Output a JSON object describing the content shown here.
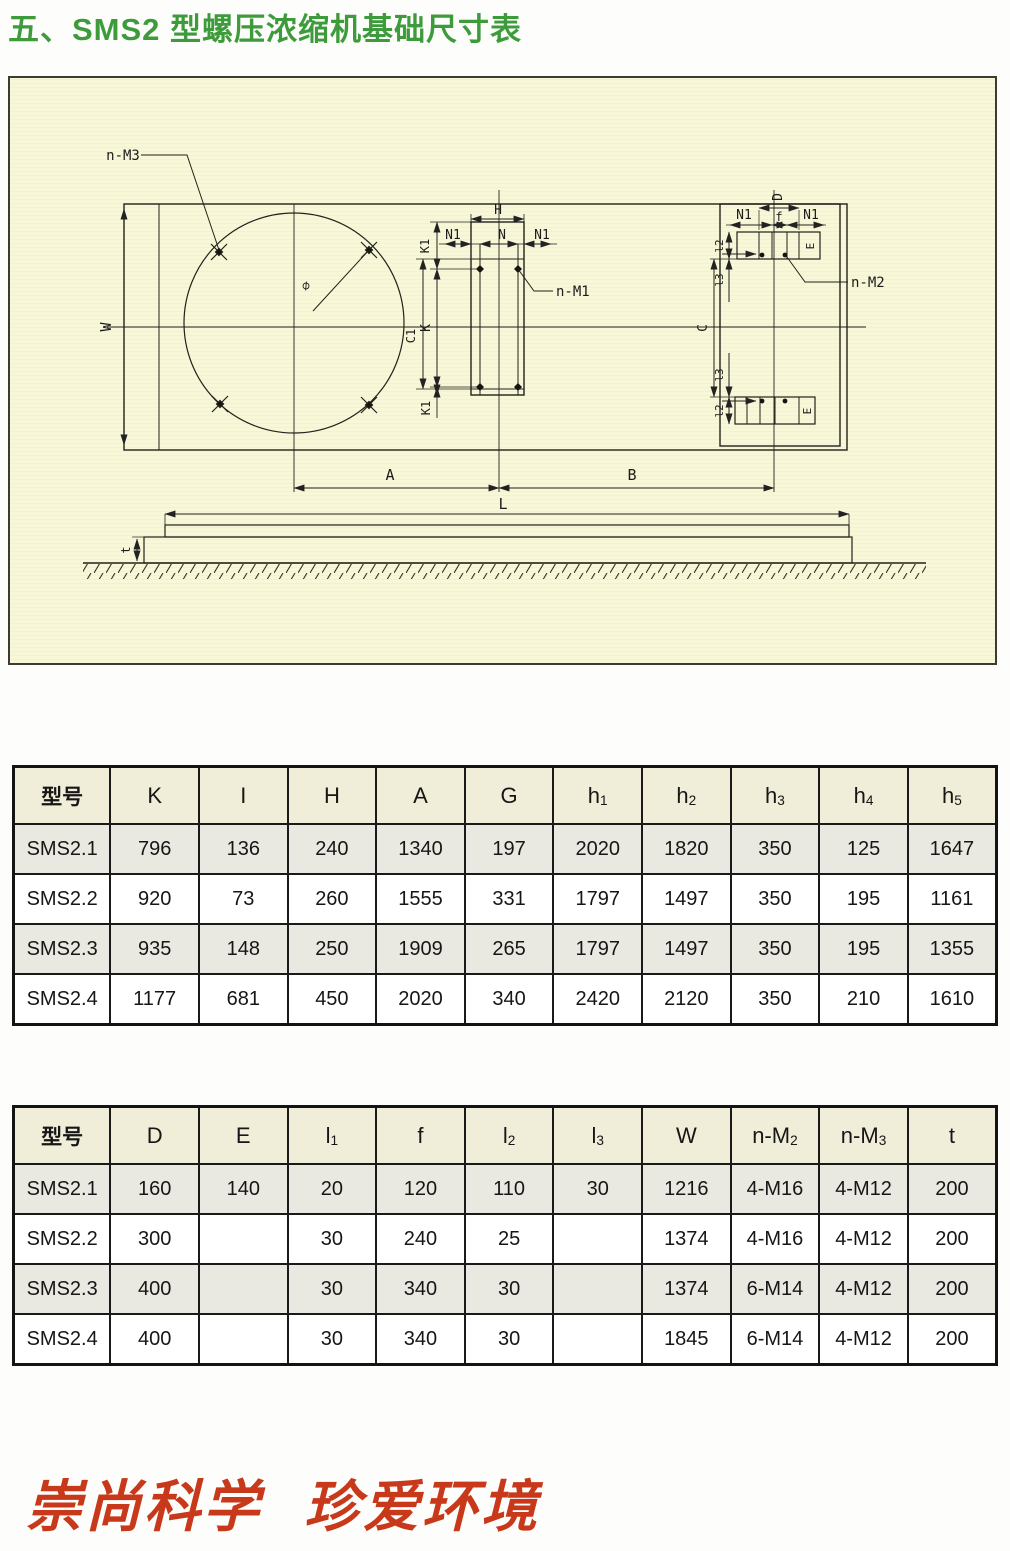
{
  "page": {
    "title": "五、SMS2 型螺压浓缩机基础尺寸表",
    "slogan_part1": "崇尚科学",
    "slogan_part2": "珍爱环境"
  },
  "diagram": {
    "labels": {
      "n_m3": "n-M3",
      "n_m1": "n-M1",
      "n_m2": "n-M2",
      "w": "W",
      "phi": "∅",
      "h": "H",
      "n": "N",
      "n1": "N1",
      "k1": "K1",
      "k": "K",
      "c1": "C1",
      "c": "C",
      "d": "D",
      "f": "f",
      "l2": "l2",
      "l3": "l3",
      "e": "E",
      "a": "A",
      "b": "B",
      "l": "L",
      "t": "t"
    }
  },
  "tables": [
    {
      "headers": [
        {
          "t": "型号",
          "s": ""
        },
        {
          "t": "K",
          "s": ""
        },
        {
          "t": "I",
          "s": ""
        },
        {
          "t": "H",
          "s": ""
        },
        {
          "t": "A",
          "s": ""
        },
        {
          "t": "G",
          "s": ""
        },
        {
          "t": "h",
          "s": "1"
        },
        {
          "t": "h",
          "s": "2"
        },
        {
          "t": "h",
          "s": "3"
        },
        {
          "t": "h",
          "s": "4"
        },
        {
          "t": "h",
          "s": "5"
        }
      ],
      "rows": [
        {
          "model": "SMS2.1",
          "cells": [
            "796",
            "136",
            "240",
            "1340",
            "197",
            "2020",
            "1820",
            "350",
            "125",
            "1647"
          ]
        },
        {
          "model": "SMS2.2",
          "cells": [
            "920",
            "73",
            "260",
            "1555",
            "331",
            "1797",
            "1497",
            "350",
            "195",
            "1161"
          ]
        },
        {
          "model": "SMS2.3",
          "cells": [
            "935",
            "148",
            "250",
            "1909",
            "265",
            "1797",
            "1497",
            "350",
            "195",
            "1355"
          ]
        },
        {
          "model": "SMS2.4",
          "cells": [
            "1177",
            "681",
            "450",
            "2020",
            "340",
            "2420",
            "2120",
            "350",
            "210",
            "1610"
          ]
        }
      ]
    },
    {
      "headers": [
        {
          "t": "型号",
          "s": ""
        },
        {
          "t": "D",
          "s": ""
        },
        {
          "t": "E",
          "s": ""
        },
        {
          "t": "l",
          "s": "1"
        },
        {
          "t": "f",
          "s": ""
        },
        {
          "t": "l",
          "s": "2"
        },
        {
          "t": "l",
          "s": "3"
        },
        {
          "t": "W",
          "s": ""
        },
        {
          "t": "n-M",
          "s": "2"
        },
        {
          "t": "n-M",
          "s": "3"
        },
        {
          "t": "t",
          "s": ""
        }
      ],
      "rows": [
        {
          "model": "SMS2.1",
          "cells": [
            "160",
            "140",
            "20",
            "120",
            "110",
            "30",
            "1216",
            "4-M16",
            "4-M12",
            "200"
          ]
        },
        {
          "model": "SMS2.2",
          "cells": [
            "300",
            "",
            "30",
            "240",
            "25",
            "",
            "1374",
            "4-M16",
            "4-M12",
            "200"
          ]
        },
        {
          "model": "SMS2.3",
          "cells": [
            "400",
            "",
            "30",
            "340",
            "30",
            "",
            "1374",
            "6-M14",
            "4-M12",
            "200"
          ]
        },
        {
          "model": "SMS2.4",
          "cells": [
            "400",
            "",
            "30",
            "340",
            "30",
            "",
            "1845",
            "6-M14",
            "4-M12",
            "200"
          ]
        }
      ]
    }
  ]
}
